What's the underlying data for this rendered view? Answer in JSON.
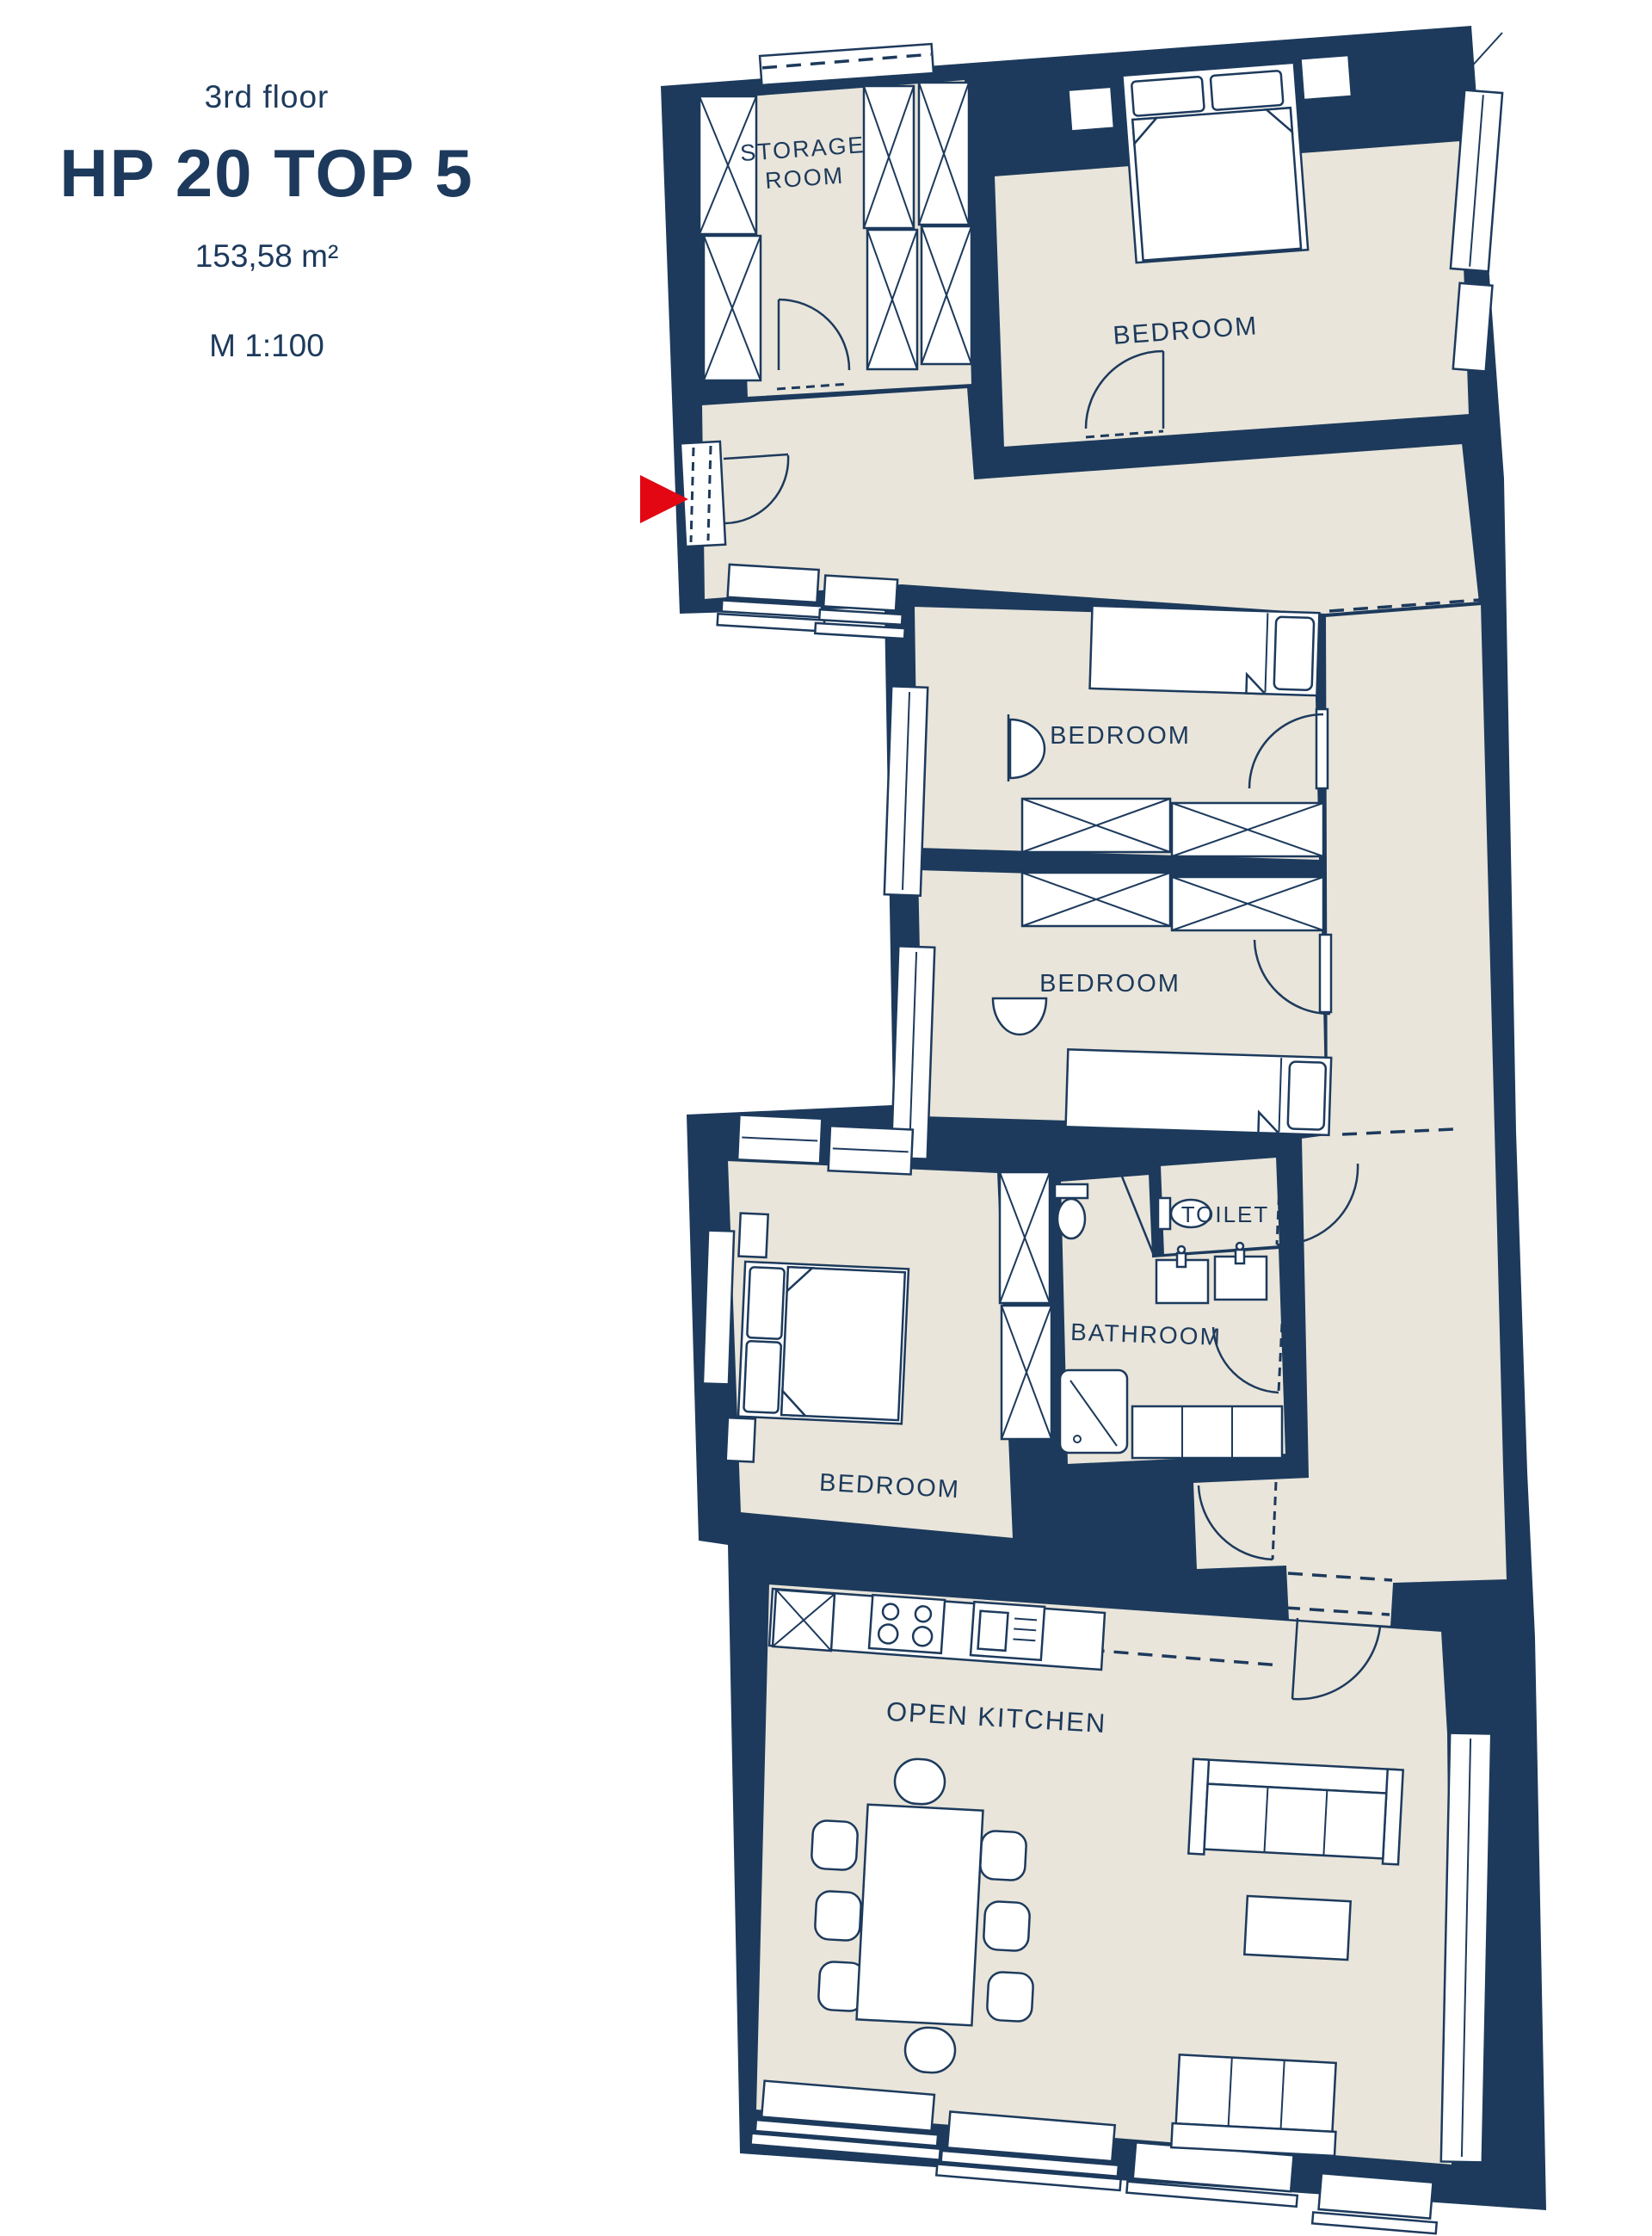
{
  "header": {
    "floor": "3rd floor",
    "unit": "HP 20 TOP 5",
    "area": "153,58 m²",
    "scale": "M 1:100"
  },
  "rooms": {
    "storage": {
      "label_line1": "STORAGE",
      "label_line2": "ROOM"
    },
    "bedroom_top": {
      "label": "BEDROOM"
    },
    "bedroom_middle_upper": {
      "label": "BEDROOM"
    },
    "bedroom_middle_lower": {
      "label": "BEDROOM"
    },
    "toilet": {
      "label": "TOILET"
    },
    "bathroom": {
      "label": "BATHROOM"
    },
    "bedroom_lower": {
      "label": "BEDROOM"
    },
    "open_kitchen": {
      "label": "OPEN KITCHEN"
    }
  },
  "colors": {
    "wall_navy": "#1d3a5c",
    "floor_beige": "#e9e5da",
    "background": "#ffffff",
    "entrance_red": "#e30613"
  },
  "icons": {
    "entrance_marker": "red-arrow-right"
  }
}
